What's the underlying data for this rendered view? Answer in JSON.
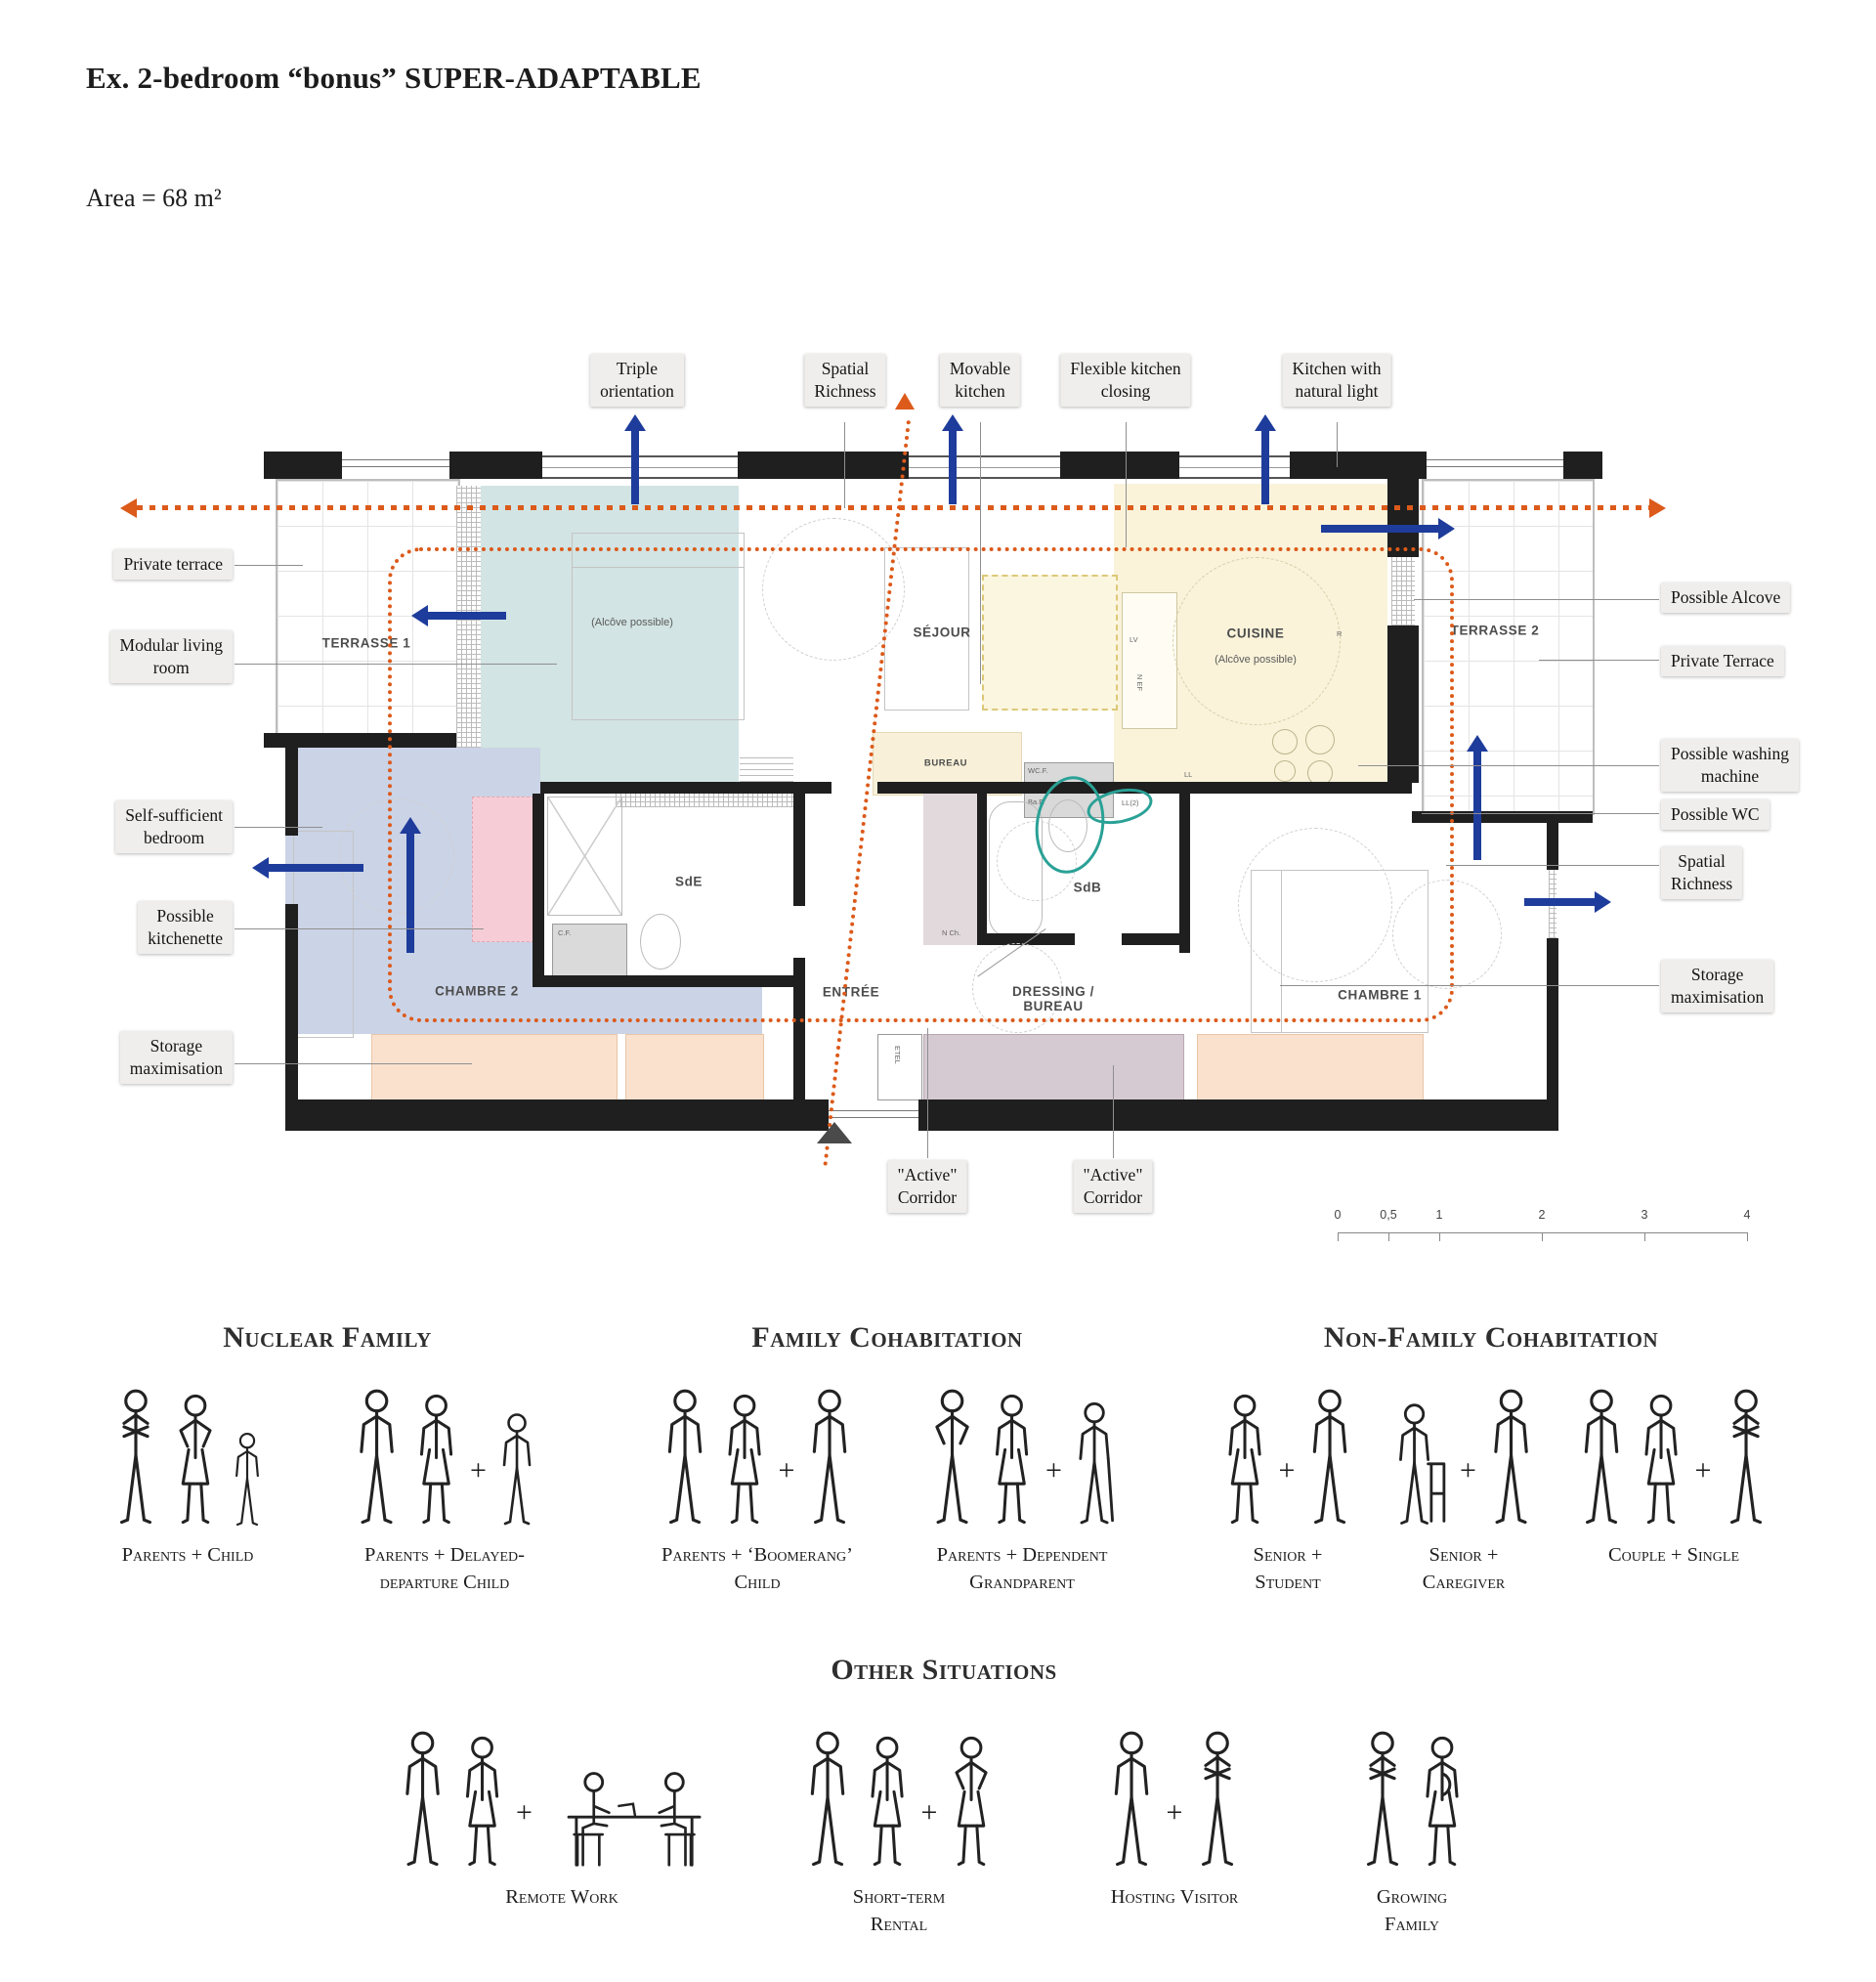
{
  "title": "Ex. 2-bedroom “bonus” SUPER-ADAPTABLE",
  "area_label": "Area = 68 m²",
  "plan": {
    "rooms": {
      "terrasse1": "TERRASSE 1",
      "terrasse2": "TERRASSE 2",
      "sejour": "SÉJOUR",
      "cuisine": "CUISINE",
      "cuisine_sub": "(Alcôve possible)",
      "living_sub": "(Alcôve possible)",
      "bureau": "BUREAU",
      "sde": "SdE",
      "sdb": "SdB",
      "chambre1": "CHAMBRE 1",
      "chambre2": "CHAMBRE 2",
      "entree": "ENTRÉE",
      "dressing": [
        "DRESSING /",
        "BUREAU"
      ]
    },
    "fixtures": {
      "lv": "LV",
      "nef": "N EF",
      "r": "R",
      "ll": "LL",
      "ll2": "LL(2)",
      "wcf": "WC.F.",
      "cf": "C.F.",
      "baf": "Ba.F.",
      "cf2": "C.F.",
      "nch": "N Ch.",
      "etel": "ETEL"
    }
  },
  "callouts": {
    "top": [
      [
        "Triple",
        "orientation"
      ],
      [
        "Spatial",
        "Richness"
      ],
      [
        "Movable",
        "kitchen"
      ],
      [
        "Flexible kitchen",
        "closing"
      ],
      [
        "Kitchen with",
        "natural light"
      ]
    ],
    "left": [
      [
        "Private terrace"
      ],
      [
        "Modular living",
        "room"
      ],
      [
        "Self-sufficient",
        "bedroom"
      ],
      [
        "Possible",
        "kitchenette"
      ],
      [
        "Storage",
        "maximisation"
      ]
    ],
    "right": [
      [
        "Possible Alcove"
      ],
      [
        "Private Terrace"
      ],
      [
        "Possible washing",
        "machine"
      ],
      [
        "Possible WC"
      ],
      [
        "Spatial",
        "Richness"
      ],
      [
        "Storage",
        "maximisation"
      ]
    ],
    "bottom": [
      [
        "\"Active\"",
        "Corridor"
      ],
      [
        "\"Active\"",
        "Corridor"
      ]
    ]
  },
  "scale_bar": {
    "labels": [
      "0",
      "0,5",
      "1",
      "2",
      "3",
      "4"
    ]
  },
  "sections": [
    {
      "title": "Nuclear Family",
      "groups": [
        {
          "label": [
            "Parents + Child"
          ],
          "figures": [
            "mc",
            "wa",
            "c"
          ]
        },
        {
          "label": [
            "Parents + Delayed-",
            "departure Child"
          ],
          "figures": [
            "m",
            "w",
            "+",
            "t"
          ]
        }
      ]
    },
    {
      "title": "Family Cohabitation",
      "groups": [
        {
          "label": [
            "Parents + ‘Boomerang’",
            "Child"
          ],
          "figures": [
            "m",
            "w",
            "+",
            "m"
          ]
        },
        {
          "label": [
            "Parents + Dependent",
            "Grandparent"
          ],
          "figures": [
            "ma",
            "w",
            "+",
            "e"
          ]
        }
      ]
    },
    {
      "title": "Non-Family Cohabitation",
      "groups": [
        {
          "label": [
            "Senior +",
            "Student"
          ],
          "figures": [
            "w",
            "+",
            "m"
          ]
        },
        {
          "label": [
            "Senior +",
            "Caregiver"
          ],
          "figures": [
            "sw",
            "+",
            "m"
          ]
        },
        {
          "label": [
            "Couple + Single"
          ],
          "figures": [
            "m",
            "w",
            "+",
            "mc"
          ]
        }
      ]
    },
    {
      "title": "Other Situations",
      "groups": [
        {
          "label": [
            "Remote Work"
          ],
          "figures": [
            "m",
            "w",
            "+",
            "d"
          ]
        },
        {
          "label": [
            "Short-term",
            "Rental"
          ],
          "figures": [
            "m",
            "w",
            "+",
            "wa"
          ]
        },
        {
          "label": [
            "Hosting Visitor"
          ],
          "figures": [
            "m",
            "+",
            "mc"
          ]
        },
        {
          "label": [
            "Growing",
            "Family"
          ],
          "figures": [
            "mc",
            "p"
          ]
        }
      ]
    }
  ],
  "colors": {
    "accent_blue": "#1e3c9b",
    "accent_orange": "#dc5a1a",
    "accent_teal": "#2aa196",
    "wall": "#1f1f1f",
    "living_room_fill": "#d2e4e3",
    "kitchen_fill": "#faf3da",
    "bedroom2_fill": "#cbd3e6",
    "kitchenette_fill": "#f6cdd6",
    "storage_peach_fill": "#fae1ce",
    "storage_mauve_fill": "#d5cad2",
    "callout_bg": "#efeeec"
  }
}
